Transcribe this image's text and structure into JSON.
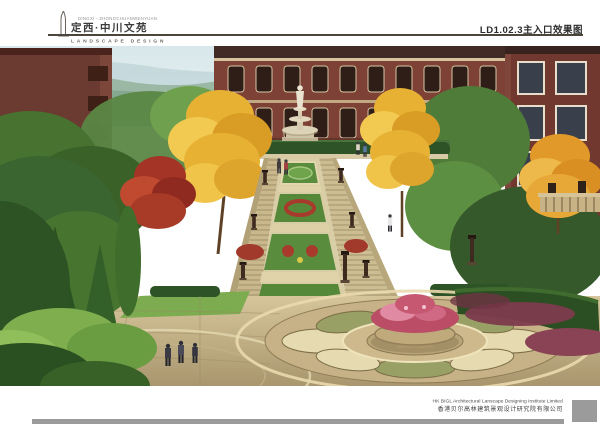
{
  "header": {
    "logo_note": "DINGXI - ZHONGCHUANWENYUAN",
    "project_title": "定西·中川文苑",
    "subtitle": "LANDSCAPE DESIGN",
    "sheet_label": "LD1.02.3主入口效果图"
  },
  "footer": {
    "credit_en": "HK BIGL Architectural Lanscape Designing Institute Limited",
    "credit_cn": "香港贝尔高林建筑景观设计研究院有限公司"
  },
  "illustration": {
    "alt": "Main-entrance rendering: grand terraced staircase with flower beds, white statue fountain, golden ginkgo and red maple trees, red-brick residential buildings, circular mosaic plaza with round flower planter, pedestrians",
    "palette": {
      "sky": "#d7e7ec",
      "haze": "#bed4d8",
      "forest": "#4a7a38",
      "forest_dark": "#2c5222",
      "gold_foliage": "#e7b133",
      "maple_red": "#a33426",
      "brick": "#7c4236",
      "brick_dark": "#5f2f28",
      "stone": "#c8b88c",
      "stone_light": "#ddd0a8",
      "statue_white": "#e9e2cf",
      "paving": "#c9b58d",
      "flower_pink": "#c75872",
      "groundcover_purple": "#7d3b4d",
      "footer_gray": "#9b9b9b",
      "rule_gray": "#4c453e"
    }
  }
}
